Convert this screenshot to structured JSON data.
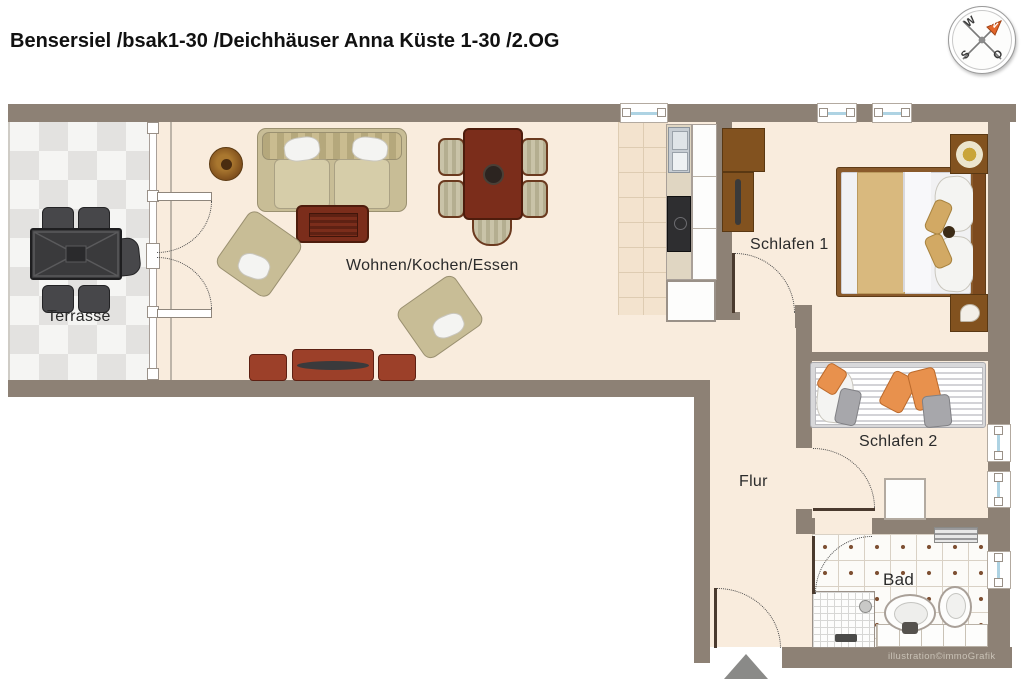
{
  "title": "Bensersiel /bsak1-30 /Deichhäuser Anna Küste 1-30 /2.OG",
  "watermark": "illustration©immoGrafik",
  "compass": {
    "west": "W",
    "south": "S",
    "east": "O",
    "north": "N"
  },
  "rooms": {
    "terrace": {
      "label": "Terrasse"
    },
    "living": {
      "label": "Wohnen/Kochen/Essen"
    },
    "bedroom1": {
      "label": "Schlafen 1"
    },
    "bedroom2": {
      "label": "Schlafen 2"
    },
    "hallway": {
      "label": "Flur"
    },
    "bathroom": {
      "label": "Bad"
    }
  },
  "colors": {
    "wall": "#8d8175",
    "floor": "#f9ecdd",
    "terrace_tile": "#e3e2e0",
    "window_glass": "#aed3e3",
    "accent_orange": "#e8914d",
    "wood_red": "#9c4029",
    "wood_brown": "#82521f"
  }
}
